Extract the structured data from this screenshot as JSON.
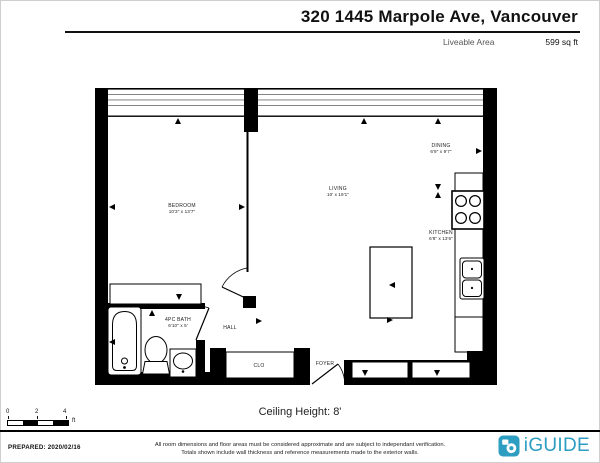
{
  "header": {
    "title": "320 1445 Marpole Ave, Vancouver",
    "area_label": "Liveable Area",
    "area_value": "599 sq ft"
  },
  "plan": {
    "rooms": [
      {
        "name": "BEDROOM",
        "dims": "10'3\" x 13'7\""
      },
      {
        "name": "LIVING",
        "dims": "10' x 19'1\""
      },
      {
        "name": "DINING",
        "dims": "6'9\" x 9'7\""
      },
      {
        "name": "KITCHEN",
        "dims": "6'8\" x 13'6\""
      },
      {
        "name": "4PC BATH",
        "dims": "6'10\" x 5'"
      },
      {
        "name": "HALL",
        "dims": ""
      },
      {
        "name": "CLO",
        "dims": ""
      },
      {
        "name": "FOYER",
        "dims": ""
      }
    ],
    "ceiling_height": "Ceiling Height: 8'"
  },
  "scale_bar": {
    "tick0": "0",
    "tick2": "2",
    "tick4": "4",
    "unit": "ft"
  },
  "footer": {
    "prepared": "PREPARED: 2020/02/16",
    "disclaimer_line1": "All room dimensions and floor areas must be considered approximate and are subject to independant verification.",
    "disclaimer_line2": "Totals shown include wall thickness and reference measurements made to the exterior walls.",
    "brand": "iGUIDE",
    "brand_color": "#2D9EC1"
  }
}
